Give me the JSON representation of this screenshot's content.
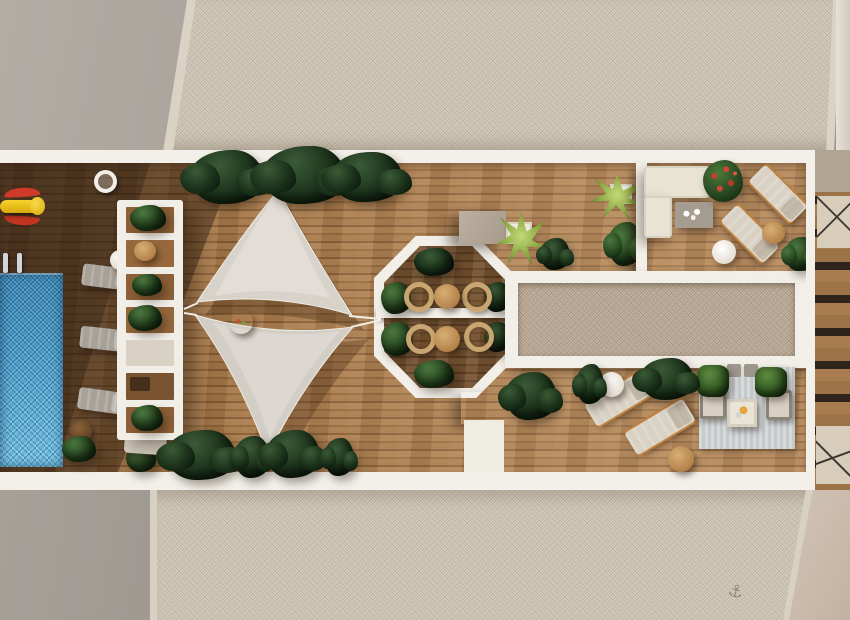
{
  "scene": {
    "title": "Aerial 3D render of a rooftop terrace with swimming pool",
    "view": "top-down",
    "style": "photorealistic architectural visualization"
  },
  "areas": {
    "roof_top": "Adjacent gravel roof (top)",
    "roof_bottom": "Adjacent gravel roof (bottom)",
    "terrace": "Wooden rooftop terrace",
    "pool": "Swimming pool with mosaic water",
    "pool_deck": "Shaded pool sun-deck",
    "pergola": "White slatted pergola with planters",
    "shade_sails": "Twin triangular shade sails",
    "pavilion": "Octagonal white dining pavilion",
    "gravel_bed": "Central framed gravel bed",
    "sofa_lounge": "Corner sofa lounge with fire table",
    "sunbed_upper": "Upper sunbathing loungers",
    "sunbed_lower": "Lower sunbathing loungers",
    "seating_rug": "Armchair seating area on rug",
    "stairs": "Neighboring stair terraces (right edge)"
  },
  "objects": {
    "pool_ladder": "Pool ladder",
    "float_toy": "Yellow-and-red pool float toy",
    "lamp": "Deck lamp",
    "dining_tables": "Round bistro tables with rattan chairs",
    "coffee_table": "Grey coffee table with candles",
    "fire_table": "White lounge table with tray",
    "anchor_mark": "Anchor mark etched in gravel"
  },
  "icons": {
    "anchor_glyph": "⚓"
  },
  "palette": {
    "deck_wood": "#a87a4e",
    "pool_blue": "#4aa8d0",
    "gravel_beige": "#c9bfb1",
    "gravel_brown": "#b5a492",
    "frame_white": "#f3f0e9",
    "sail_grey": "#d7d2c9",
    "foliage_dark": "#1d3320",
    "foliage_light": "#8fae46",
    "wicker_tan": "#c9a571",
    "accent_orange": "#c0813f",
    "toy_red": "#d03a28",
    "toy_yellow": "#f0c020"
  },
  "counts": {
    "pool_loungers": 3,
    "upper_loungers": 2,
    "lower_loungers": 2,
    "pavilion_chairs": 4,
    "shade_sails": 2
  }
}
